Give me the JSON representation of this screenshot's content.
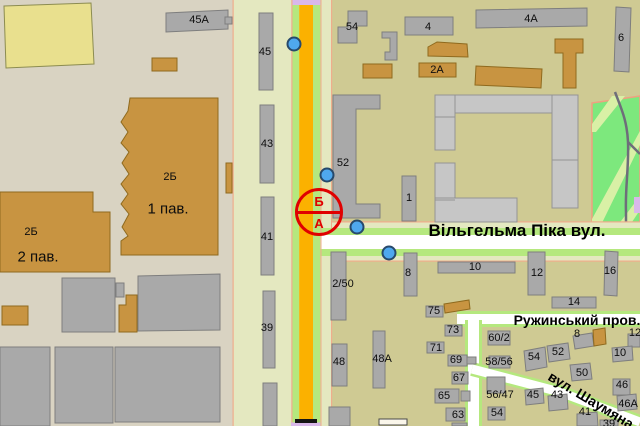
{
  "map": {
    "street_labels": [
      {
        "name": "Вільгельма Піка вул.",
        "x": 517,
        "y": 231,
        "size": 17,
        "rotation": 0
      },
      {
        "name": "Ружинський пров.",
        "x": 577,
        "y": 320,
        "size": 14,
        "rotation": 0
      },
      {
        "name": "вул. Шаумяна",
        "x": 591,
        "y": 400,
        "size": 14,
        "rotation": 31
      }
    ],
    "building_labels": [
      {
        "text": "45А",
        "x": 199,
        "y": 20
      },
      {
        "text": "2Б",
        "x": 170,
        "y": 177
      },
      {
        "text": "1 пав.",
        "x": 168,
        "y": 209,
        "size": 15
      },
      {
        "text": "2Б",
        "x": 31,
        "y": 232
      },
      {
        "text": "2 пав.",
        "x": 38,
        "y": 257,
        "size": 15
      },
      {
        "text": "45",
        "x": 265,
        "y": 52
      },
      {
        "text": "43",
        "x": 267,
        "y": 144
      },
      {
        "text": "41",
        "x": 267,
        "y": 237
      },
      {
        "text": "39",
        "x": 267,
        "y": 328
      },
      {
        "text": "54",
        "x": 352,
        "y": 27
      },
      {
        "text": "4",
        "x": 428,
        "y": 27
      },
      {
        "text": "4А",
        "x": 531,
        "y": 19
      },
      {
        "text": "2А",
        "x": 437,
        "y": 70
      },
      {
        "text": "6",
        "x": 621,
        "y": 38
      },
      {
        "text": "52",
        "x": 343,
        "y": 163
      },
      {
        "text": "1",
        "x": 409,
        "y": 198
      },
      {
        "text": "2/50",
        "x": 343,
        "y": 284
      },
      {
        "text": "8",
        "x": 408,
        "y": 273
      },
      {
        "text": "10",
        "x": 475,
        "y": 267
      },
      {
        "text": "12",
        "x": 537,
        "y": 273
      },
      {
        "text": "16",
        "x": 610,
        "y": 271
      },
      {
        "text": "14",
        "x": 574,
        "y": 302
      },
      {
        "text": "75",
        "x": 434,
        "y": 311
      },
      {
        "text": "73",
        "x": 453,
        "y": 330
      },
      {
        "text": "71",
        "x": 436,
        "y": 348
      },
      {
        "text": "69",
        "x": 456,
        "y": 360
      },
      {
        "text": "67",
        "x": 459,
        "y": 378
      },
      {
        "text": "65",
        "x": 444,
        "y": 396
      },
      {
        "text": "63",
        "x": 458,
        "y": 415
      },
      {
        "text": "48",
        "x": 339,
        "y": 362
      },
      {
        "text": "48А",
        "x": 382,
        "y": 359
      },
      {
        "text": "60/2",
        "x": 499,
        "y": 338
      },
      {
        "text": "58/56",
        "x": 499,
        "y": 362
      },
      {
        "text": "56/47",
        "x": 500,
        "y": 395
      },
      {
        "text": "54",
        "x": 497,
        "y": 413
      },
      {
        "text": "54",
        "x": 534,
        "y": 357
      },
      {
        "text": "52",
        "x": 558,
        "y": 352
      },
      {
        "text": "50",
        "x": 582,
        "y": 373
      },
      {
        "text": "45",
        "x": 533,
        "y": 395
      },
      {
        "text": "43",
        "x": 557,
        "y": 395
      },
      {
        "text": "41",
        "x": 585,
        "y": 412
      },
      {
        "text": "8",
        "x": 577,
        "y": 334
      },
      {
        "text": "12",
        "x": 635,
        "y": 333
      },
      {
        "text": "10",
        "x": 620,
        "y": 353
      },
      {
        "text": "46",
        "x": 622,
        "y": 385
      },
      {
        "text": "46А",
        "x": 628,
        "y": 404
      },
      {
        "text": "39",
        "x": 609,
        "y": 424
      }
    ],
    "selection_marker": {
      "top_label": "Б",
      "bottom_label": "А",
      "x": 319,
      "y": 212,
      "radius": 24,
      "color": "#e00000"
    },
    "point_markers": {
      "color": "#4fa8ee",
      "points": [
        {
          "x": 294,
          "y": 44
        },
        {
          "x": 327,
          "y": 175
        },
        {
          "x": 357,
          "y": 227
        },
        {
          "x": 389,
          "y": 253
        }
      ]
    },
    "colors": {
      "district_west_bg": "#d9d3c2",
      "district_east_bg": "#cfca93",
      "road_corridor": "#e4e8c0",
      "main_road_orange": "#fbb100",
      "road_green_verge": "#b5e87e",
      "road_white": "#ffffff",
      "road_outline_peach": "#efad8c",
      "building_gray": "#a9a9a9",
      "building_tan": "#c89441",
      "building_light_gray": "#c6c6c6",
      "building_yellow": "#e9e08e",
      "park_green": "#7de87d",
      "park_path": "#d9f0a6",
      "tram_purple": "#d9b8ea",
      "selection_red": "#e00000",
      "marker_blue": "#4fa8ee"
    }
  }
}
